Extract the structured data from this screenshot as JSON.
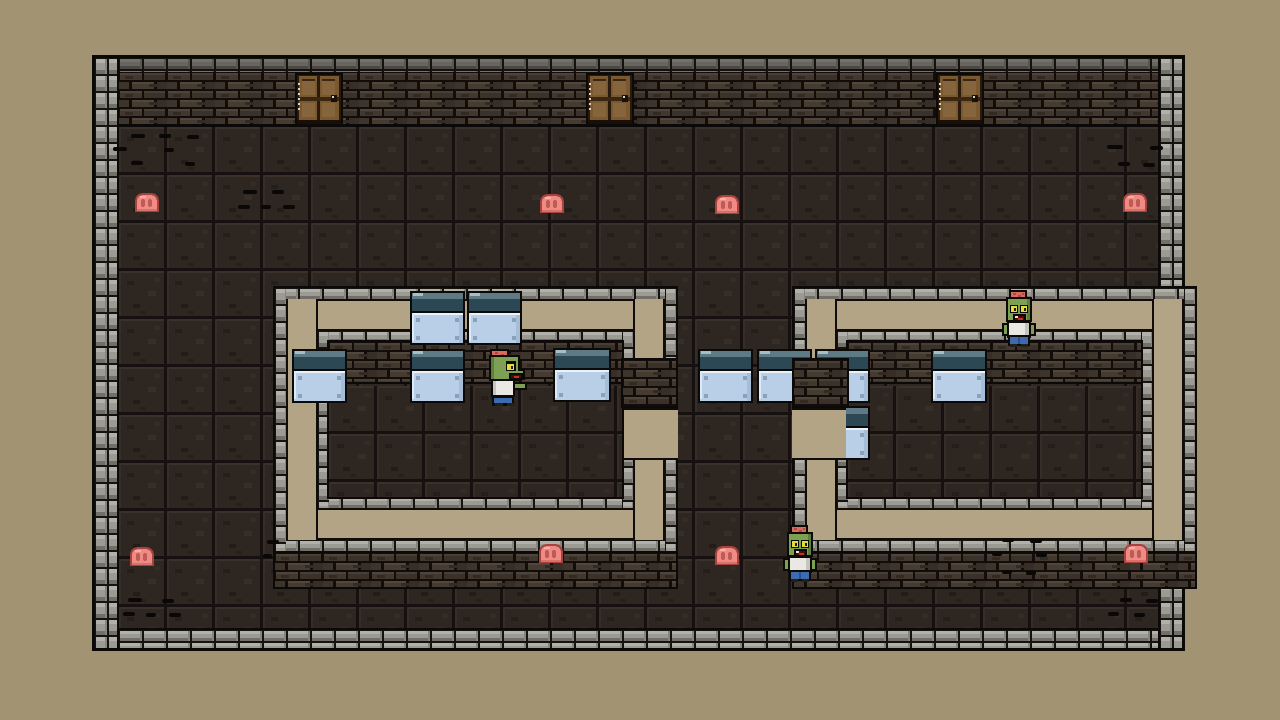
{
  "meta": {
    "view_label": "top-down dungeon room"
  },
  "palette": {
    "background_tan": "#a29372",
    "ring_tan": "#b3a486",
    "stone": "#9c9b93",
    "stone_light": "#b2b1a9",
    "stone_dark": "#716f68",
    "mortar": "#15130f",
    "brick": "#42382e",
    "brick_light": "#4e443a",
    "brick_dark": "#332b23",
    "brick_mortar": "#120d0a",
    "floor": "#2e2721",
    "floor_seam": "#161110",
    "outline_black": "#0c0a08",
    "table_body": "#b9cfe7",
    "table_top": "#2c4854",
    "table_top_light": "#5d7a85",
    "table_top_glint": "#a7bec6",
    "table_highlight": "#e8f2fa",
    "table_corner": "#8aa2b8",
    "table_shade": "#a6bdd8",
    "blob_fill": "#ee8b84",
    "blob_spot": "#c05a55",
    "blob_line": "#a8423e",
    "blob_light": "#f7aea7",
    "zombie_skin": "#7da052",
    "zombie_skin_dark": "#5d7f3c",
    "zombie_brain": "#d96a60",
    "zombie_brain_dark": "#b04840",
    "zombie_eye": "#e6dc38",
    "zombie_pupil": "#1c1c14",
    "zombie_shirt": "#e9e8e2",
    "zombie_shirt_shade": "#c6c5bd",
    "zombie_pants": "#3e6bb0",
    "zombie_pants_dark": "#2c4f8c",
    "zombie_mouth": "#4a0e08",
    "zombie_tongue": "#c23326",
    "door_wood": "#7b5930",
    "door_wood_light": "#86653c",
    "door_frame": "#2a1a0e",
    "door_rail": "#3a2712",
    "door_sill": "#1a0f06",
    "door_knob": "#17110b",
    "door_knob_glint": "#d6d0c0",
    "door_hinge_dot": "#d9d2c2"
  },
  "labels": {
    "door": "wooden-door",
    "blob": "flesh-blob",
    "table": "counter-table",
    "zombie": "zombie",
    "crack": "floor-crack"
  },
  "scene": {
    "doors": [
      {
        "x": 295,
        "y": 73
      },
      {
        "x": 586,
        "y": 73
      },
      {
        "x": 936,
        "y": 73
      }
    ],
    "blobs": [
      {
        "x": 133,
        "y": 191
      },
      {
        "x": 538,
        "y": 192
      },
      {
        "x": 713,
        "y": 193
      },
      {
        "x": 1121,
        "y": 191
      },
      {
        "x": 128,
        "y": 545
      },
      {
        "x": 537,
        "y": 542
      },
      {
        "x": 713,
        "y": 544
      },
      {
        "x": 1122,
        "y": 542
      }
    ],
    "tables": [
      {
        "x": 410,
        "y": 291
      },
      {
        "x": 467,
        "y": 291
      },
      {
        "x": 292,
        "y": 349
      },
      {
        "x": 410,
        "y": 349
      },
      {
        "x": 553,
        "y": 348,
        "w": 58
      },
      {
        "x": 698,
        "y": 349
      },
      {
        "x": 757,
        "y": 349
      },
      {
        "x": 815,
        "y": 349
      },
      {
        "x": 815,
        "y": 406
      },
      {
        "x": 931,
        "y": 349,
        "w": 56
      }
    ],
    "zombies": [
      {
        "x": 483,
        "y": 349,
        "pose": "side"
      },
      {
        "x": 1001,
        "y": 290,
        "pose": "front"
      },
      {
        "x": 782,
        "y": 525,
        "pose": "front"
      }
    ],
    "cracks": [
      {
        "x": 131,
        "y": 134,
        "w": 14
      },
      {
        "x": 159,
        "y": 134,
        "w": 12
      },
      {
        "x": 187,
        "y": 135,
        "w": 12
      },
      {
        "x": 113,
        "y": 147,
        "w": 14
      },
      {
        "x": 164,
        "y": 148,
        "w": 10
      },
      {
        "x": 131,
        "y": 161,
        "w": 12
      },
      {
        "x": 185,
        "y": 162,
        "w": 10
      },
      {
        "x": 243,
        "y": 190,
        "w": 14
      },
      {
        "x": 272,
        "y": 190,
        "w": 12
      },
      {
        "x": 238,
        "y": 205,
        "w": 12
      },
      {
        "x": 261,
        "y": 205,
        "w": 10
      },
      {
        "x": 283,
        "y": 205,
        "w": 12
      },
      {
        "x": 1107,
        "y": 145,
        "w": 16
      },
      {
        "x": 1150,
        "y": 146,
        "w": 13
      },
      {
        "x": 1118,
        "y": 162,
        "w": 12
      },
      {
        "x": 1143,
        "y": 163,
        "w": 12
      },
      {
        "x": 128,
        "y": 598,
        "w": 14
      },
      {
        "x": 162,
        "y": 599,
        "w": 12
      },
      {
        "x": 123,
        "y": 612,
        "w": 12
      },
      {
        "x": 146,
        "y": 613,
        "w": 10
      },
      {
        "x": 169,
        "y": 613,
        "w": 12
      },
      {
        "x": 1002,
        "y": 538,
        "w": 12
      },
      {
        "x": 1030,
        "y": 539,
        "w": 12
      },
      {
        "x": 992,
        "y": 552,
        "w": 10
      },
      {
        "x": 1036,
        "y": 553,
        "w": 11
      },
      {
        "x": 1002,
        "y": 570,
        "w": 10
      },
      {
        "x": 1026,
        "y": 571,
        "w": 10
      },
      {
        "x": 1120,
        "y": 598,
        "w": 12
      },
      {
        "x": 1146,
        "y": 599,
        "w": 12
      },
      {
        "x": 1108,
        "y": 612,
        "w": 11
      },
      {
        "x": 1134,
        "y": 613,
        "w": 11
      },
      {
        "x": 267,
        "y": 540,
        "w": 12
      },
      {
        "x": 263,
        "y": 554,
        "w": 9
      }
    ]
  }
}
